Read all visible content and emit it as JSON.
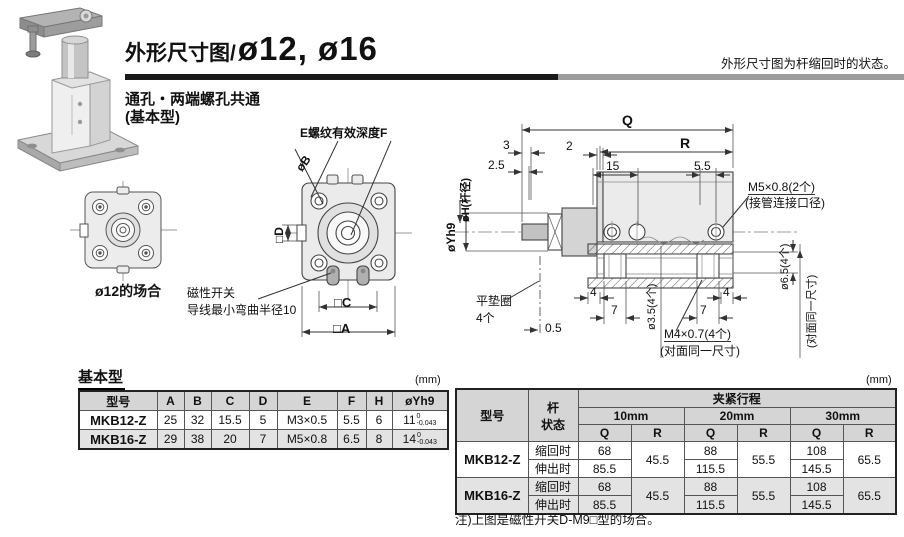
{
  "header": {
    "title_prefix": "外形尺寸图/",
    "title_bore": "ø12, ø16",
    "state_note": "外形尺寸图为杆缩回时的状态。",
    "subtitle1": "通孔・两端螺孔共通",
    "subtitle2": "(基本型)"
  },
  "front_view": {
    "caption_small": "ø12的场合",
    "thread_label": "E螺纹有效深度F",
    "bolt_dia": "øB",
    "dim_d": "□D",
    "dim_c": "□C",
    "dim_a": "□A",
    "switch_note1": "磁性开关",
    "switch_note2": "导线最小弯曲半径10"
  },
  "side_view": {
    "dim_q": "Q",
    "dim_r": "R",
    "dim_3": "3",
    "dim_2": "2",
    "dim_2_5": "2.5",
    "dim_15": "15",
    "dim_5_5": "5.5",
    "rod_dia": "øH(杆径)",
    "pilot_dia": "øYh9",
    "port_label1": "M5×0.8(2个)",
    "port_label2": "(接管连接口径)",
    "hole_dia_65": "ø6.5(4个)",
    "same_dim_right": "(对面同一尺寸)",
    "washer1": "平垫圈",
    "washer2": "4个",
    "dim_0_5": "0.5",
    "dim_4_left": "4",
    "dim_7_left": "7",
    "dim_4_right": "4",
    "dim_7_right": "7",
    "hole_dia_35": "ø3.5(4个)",
    "thread_m4": "M4×0.7(4个)",
    "same_dim_bottom": "(对面同一尺寸)"
  },
  "basic_table": {
    "title": "基本型",
    "unit": "(mm)",
    "headers": [
      "型号",
      "A",
      "B",
      "C",
      "D",
      "E",
      "F",
      "H",
      "øYh9"
    ],
    "rows": [
      {
        "model": "MKB12-Z",
        "A": "25",
        "B": "32",
        "C": "15.5",
        "D": "5",
        "E": "M3×0.5",
        "F": "5.5",
        "H": "6",
        "Y": "11",
        "Ytop": "0",
        "Ybot": "-0.043"
      },
      {
        "model": "MKB16-Z",
        "A": "29",
        "B": "38",
        "C": "20",
        "D": "7",
        "E": "M5×0.8",
        "F": "6.5",
        "H": "8",
        "Y": "14",
        "Ytop": "0",
        "Ybot": "-0.043"
      }
    ]
  },
  "stroke_table": {
    "unit": "(mm)",
    "model_header": "型号",
    "rod_state_header1": "杆",
    "rod_state_header2": "状态",
    "clamp_header": "夹紧行程",
    "stroke_headers": [
      "10mm",
      "20mm",
      "30mm"
    ],
    "q_label": "Q",
    "r_label": "R",
    "rows": [
      {
        "model": "MKB12-Z",
        "state_a": "缩回时",
        "state_b": "伸出时",
        "q10_a": "68",
        "q10_b": "85.5",
        "r10": "45.5",
        "q20_a": "88",
        "q20_b": "115.5",
        "r20": "55.5",
        "q30_a": "108",
        "q30_b": "145.5",
        "r30": "65.5"
      },
      {
        "model": "MKB16-Z",
        "state_a": "缩回时",
        "state_b": "伸出时",
        "q10_a": "68",
        "q10_b": "85.5",
        "r10": "45.5",
        "q20_a": "88",
        "q20_b": "115.5",
        "r20": "55.5",
        "q30_a": "108",
        "q30_b": "145.5",
        "r30": "65.5"
      }
    ],
    "footnote": "注)上图是磁性开关D-M9□型的场合。"
  }
}
